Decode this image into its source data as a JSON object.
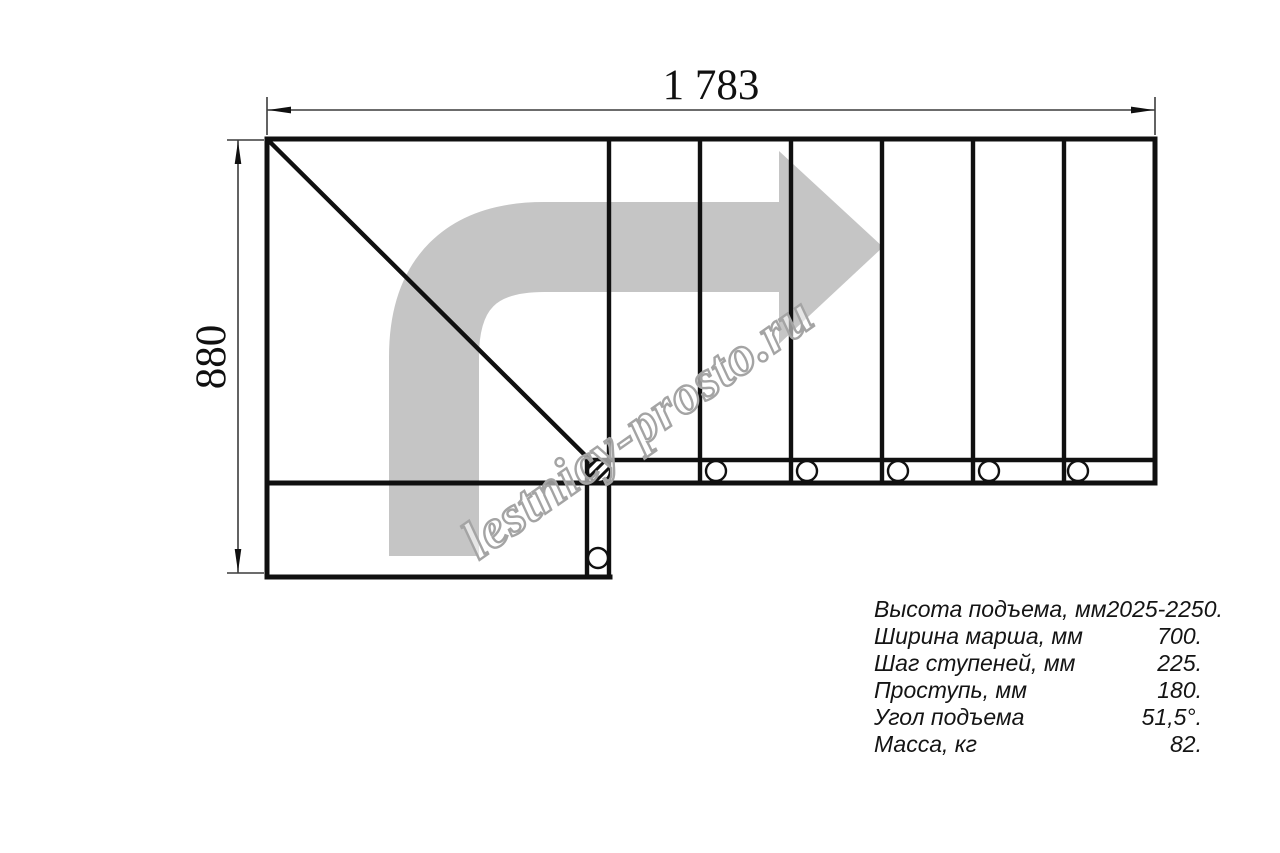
{
  "drawing": {
    "top_dimension_label": "1 783",
    "left_dimension_label": "880",
    "watermark_text": "lestnicy-prosto.ru",
    "tread_count": 6,
    "colors": {
      "line": "#101010",
      "direction_arrow": "#c5c5c5",
      "watermark_outline": "#a4a4a4"
    }
  },
  "specs": {
    "rows": [
      {
        "label": "Высота подъема, мм",
        "value": "2025-2250."
      },
      {
        "label": "Ширина марша, мм",
        "value": "700."
      },
      {
        "label": "Шаг ступеней, мм",
        "value": "225."
      },
      {
        "label": "Проступь, мм",
        "value": "180."
      },
      {
        "label": "Угол подъема",
        "value": "51,5°."
      },
      {
        "label": "Масса, кг",
        "value": "82."
      }
    ]
  }
}
